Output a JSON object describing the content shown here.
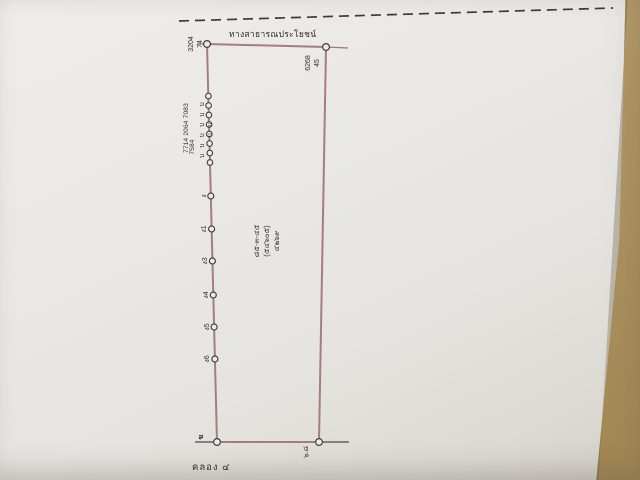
{
  "photo": {
    "paper_color": "#e9e7e3",
    "desk_color": "#ad9260",
    "boundary_color": "#a17779",
    "ink_color": "#3a3836"
  },
  "labels": {
    "top_road": "ทางสาธารณประโยชน์",
    "canal": "คลอง ๔"
  },
  "markers": {
    "top_left": {
      "col1": "3204",
      "col2": "74"
    },
    "top_right": {
      "col1": "6268",
      "col2": "45"
    },
    "bottom_left": "ฆ",
    "bottom_right": "๖.๘",
    "cluster_letters": "บ บ บ บ บ บ บ บ",
    "cluster_numbers_1": "7714 2064 7083",
    "cluster_numbers_2": "7584",
    "point_labels": [
      "ง",
      "ง1",
      "ง3",
      "ง4",
      "ง5",
      "ง6"
    ]
  },
  "parcel_text": {
    "line_area": "๘๕-๓-๔๕",
    "line_mid": "(๕๔๖๐๕)",
    "line_no": "๔๒๖๙"
  }
}
